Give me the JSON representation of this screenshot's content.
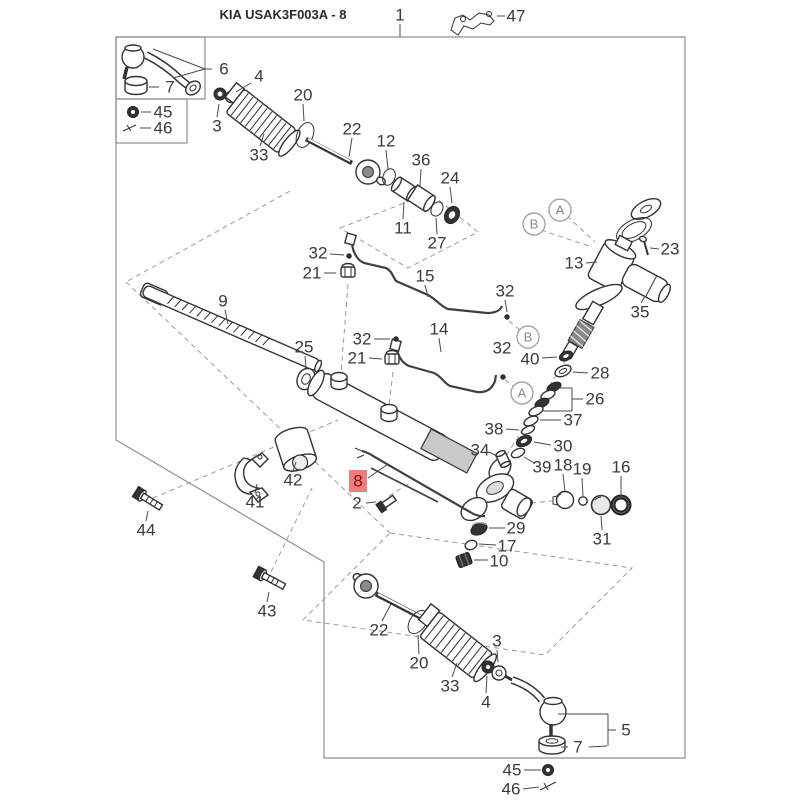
{
  "diagram": {
    "title": "KIA USAK3F003A - 8",
    "highlighted_part": "8",
    "highlight_bg": "#f17c7c",
    "highlight_text_color": "#7c1212",
    "callouts": [
      {
        "part": "1",
        "x": 400,
        "y": 15
      },
      {
        "part": "47",
        "x": 516,
        "y": 16
      },
      {
        "part": "6",
        "x": 224,
        "y": 69
      },
      {
        "part": "7",
        "x": 170,
        "y": 87
      },
      {
        "part": "45",
        "x": 163,
        "y": 112
      },
      {
        "part": "46",
        "x": 163,
        "y": 128
      },
      {
        "part": "3",
        "x": 217,
        "y": 126
      },
      {
        "part": "4",
        "x": 259,
        "y": 76
      },
      {
        "part": "20",
        "x": 303,
        "y": 95
      },
      {
        "part": "33",
        "x": 259,
        "y": 155
      },
      {
        "part": "22",
        "x": 352,
        "y": 129
      },
      {
        "part": "12",
        "x": 386,
        "y": 141
      },
      {
        "part": "36",
        "x": 421,
        "y": 160
      },
      {
        "part": "24",
        "x": 450,
        "y": 178
      },
      {
        "part": "11",
        "x": 403,
        "y": 228
      },
      {
        "part": "27",
        "x": 437,
        "y": 243
      },
      {
        "part": "32",
        "x": 318,
        "y": 253
      },
      {
        "part": "21",
        "x": 312,
        "y": 273
      },
      {
        "part": "15",
        "x": 425,
        "y": 276
      },
      {
        "part": "32",
        "x": 505,
        "y": 291
      },
      {
        "part": "14",
        "x": 439,
        "y": 329
      },
      {
        "part": "32",
        "x": 362,
        "y": 339
      },
      {
        "part": "21",
        "x": 357,
        "y": 358
      },
      {
        "part": "9",
        "x": 223,
        "y": 301
      },
      {
        "part": "25",
        "x": 304,
        "y": 347
      },
      {
        "part": "13",
        "x": 574,
        "y": 263
      },
      {
        "part": "23",
        "x": 670,
        "y": 249
      },
      {
        "part": "35",
        "x": 640,
        "y": 312
      },
      {
        "part": "32",
        "x": 502,
        "y": 348
      },
      {
        "part": "40",
        "x": 530,
        "y": 359
      },
      {
        "part": "28",
        "x": 600,
        "y": 373
      },
      {
        "part": "26",
        "x": 595,
        "y": 399
      },
      {
        "part": "37",
        "x": 573,
        "y": 420
      },
      {
        "part": "38",
        "x": 494,
        "y": 429
      },
      {
        "part": "30",
        "x": 563,
        "y": 446
      },
      {
        "part": "34",
        "x": 480,
        "y": 450
      },
      {
        "part": "39",
        "x": 542,
        "y": 467
      },
      {
        "part": "18",
        "x": 563,
        "y": 465
      },
      {
        "part": "19",
        "x": 582,
        "y": 469
      },
      {
        "part": "16",
        "x": 621,
        "y": 467
      },
      {
        "part": "31",
        "x": 602,
        "y": 539
      },
      {
        "part": "29",
        "x": 516,
        "y": 528
      },
      {
        "part": "17",
        "x": 507,
        "y": 546
      },
      {
        "part": "10",
        "x": 499,
        "y": 561
      },
      {
        "part": "42",
        "x": 293,
        "y": 480
      },
      {
        "part": "41",
        "x": 255,
        "y": 502
      },
      {
        "part": "44",
        "x": 146,
        "y": 530
      },
      {
        "part": "43",
        "x": 267,
        "y": 611
      },
      {
        "part": "8",
        "x": 358,
        "y": 481,
        "highlight": true
      },
      {
        "part": "2",
        "x": 357,
        "y": 503
      },
      {
        "part": "22",
        "x": 379,
        "y": 630
      },
      {
        "part": "20",
        "x": 419,
        "y": 663
      },
      {
        "part": "33",
        "x": 450,
        "y": 686
      },
      {
        "part": "3",
        "x": 497,
        "y": 641
      },
      {
        "part": "4",
        "x": 486,
        "y": 702
      },
      {
        "part": "5",
        "x": 626,
        "y": 730
      },
      {
        "part": "7",
        "x": 578,
        "y": 747
      },
      {
        "part": "45",
        "x": 512,
        "y": 770
      },
      {
        "part": "46",
        "x": 511,
        "y": 789
      }
    ],
    "ref_letters": [
      {
        "letter": "A",
        "x": 560,
        "y": 210
      },
      {
        "letter": "B",
        "x": 534,
        "y": 224
      },
      {
        "letter": "B",
        "x": 528,
        "y": 337
      },
      {
        "letter": "A",
        "x": 522,
        "y": 393
      }
    ]
  }
}
